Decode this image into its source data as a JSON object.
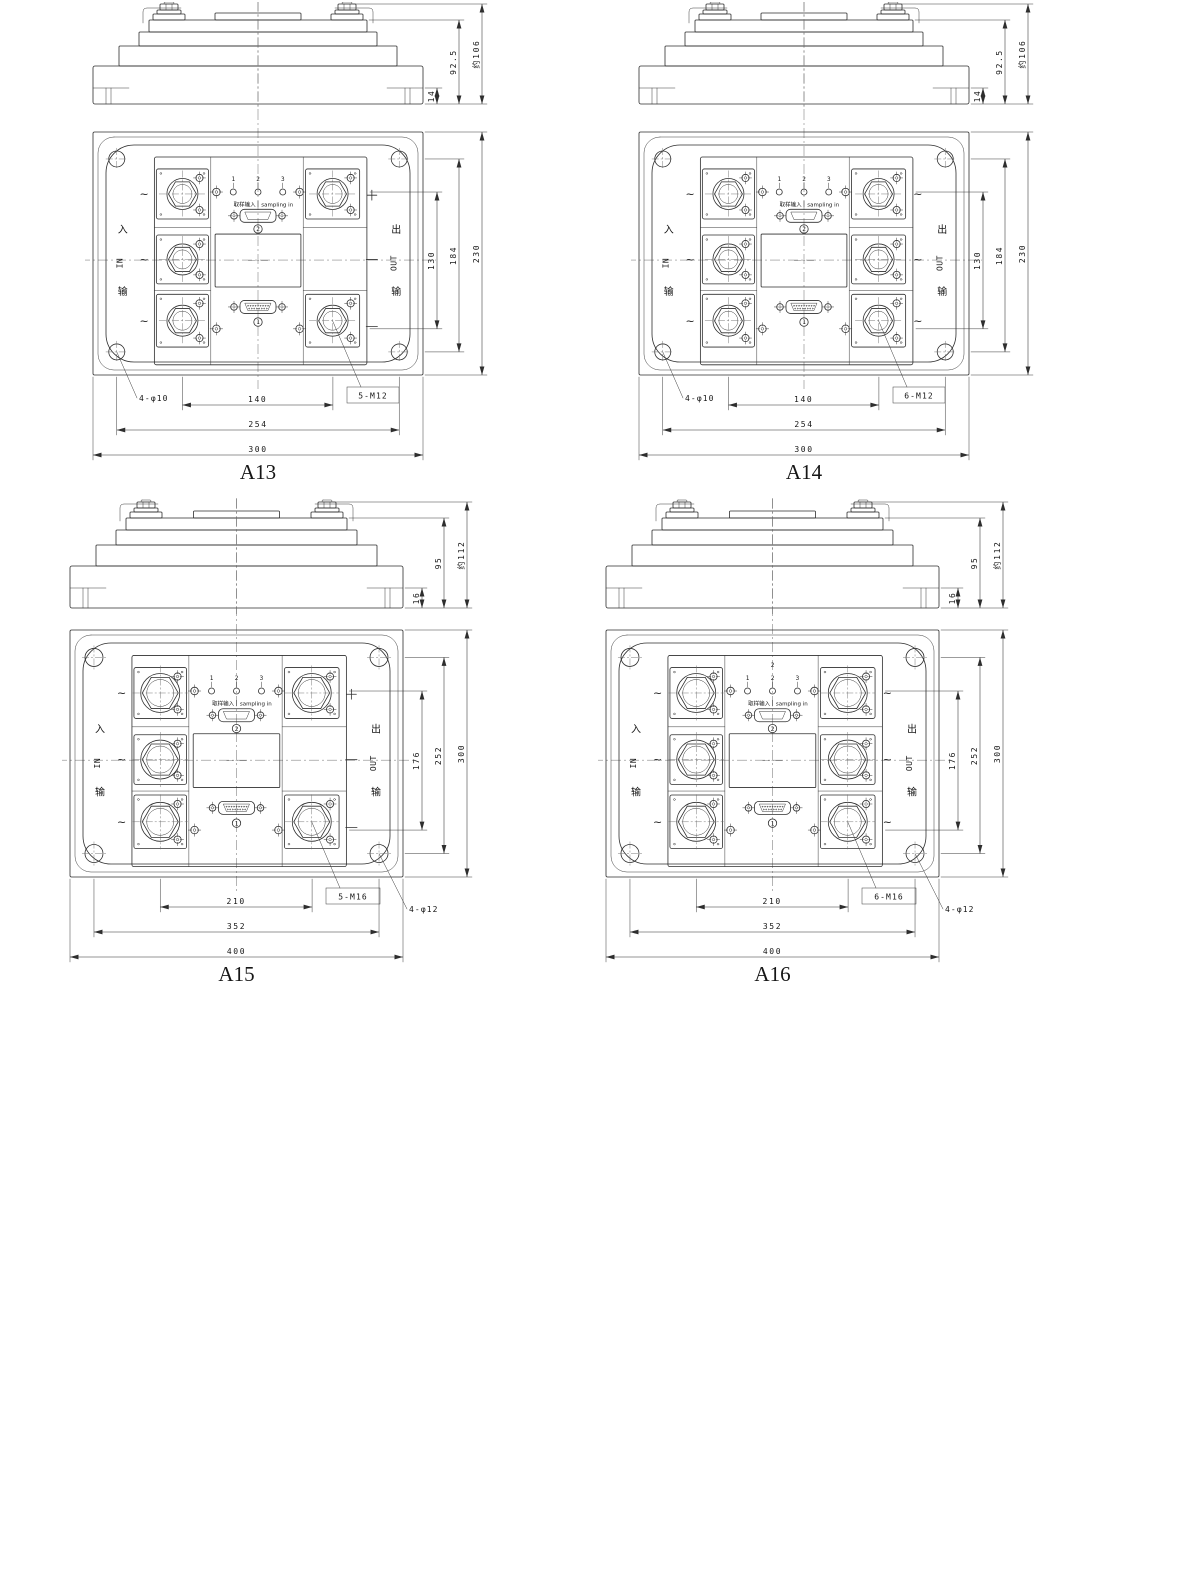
{
  "sheet": {
    "background_color": "#ffffff",
    "line_color": "#2e2e2e",
    "text_color": "#161616"
  },
  "shared_labels": {
    "input_vertical": [
      "入",
      "IN",
      "输"
    ],
    "output_vertical": [
      "出",
      "OUT",
      "输"
    ],
    "sampling_label_cn": "取样输入",
    "sampling_label_en": "sampling in",
    "sampling_terminal_numbers": [
      "1",
      "2",
      "3"
    ],
    "top_connector_mark": "2",
    "bottom_connector_mark": "1",
    "ac_mark": "~",
    "plus_mark": "+"
  },
  "figures": [
    {
      "id": "A13",
      "title": "A13",
      "size": "small",
      "main_terminal_count": 5,
      "side_view_dims": [
        "14",
        "92.5",
        "约106"
      ],
      "vertical_dims": [
        "130",
        "184",
        "230"
      ],
      "horizontal_dims": [
        "140",
        "254",
        "300"
      ],
      "mounting_hole_callout": "4-φ10",
      "terminal_callout": "5-M12"
    },
    {
      "id": "A14",
      "title": "A14",
      "size": "small",
      "main_terminal_count": 6,
      "side_view_dims": [
        "14",
        "92.5",
        "约106"
      ],
      "vertical_dims": [
        "130",
        "184",
        "230"
      ],
      "horizontal_dims": [
        "140",
        "254",
        "300"
      ],
      "mounting_hole_callout": "4-φ10",
      "terminal_callout": "6-M12"
    },
    {
      "id": "A15",
      "title": "A15",
      "size": "large",
      "main_terminal_count": 5,
      "side_view_dims": [
        "16",
        "95",
        "约112"
      ],
      "vertical_dims": [
        "176",
        "252",
        "300"
      ],
      "horizontal_dims": [
        "210",
        "352",
        "400"
      ],
      "mounting_hole_callout": "4-φ12",
      "terminal_callout": "5-M16"
    },
    {
      "id": "A16",
      "title": "A16",
      "size": "large",
      "main_terminal_count": 6,
      "side_view_dims": [
        "16",
        "95",
        "约112"
      ],
      "vertical_dims": [
        "176",
        "252",
        "300"
      ],
      "horizontal_dims": [
        "210",
        "352",
        "400"
      ],
      "mounting_hole_callout": "4-φ12",
      "terminal_callout": "6-M16",
      "top_mark": "2"
    }
  ]
}
